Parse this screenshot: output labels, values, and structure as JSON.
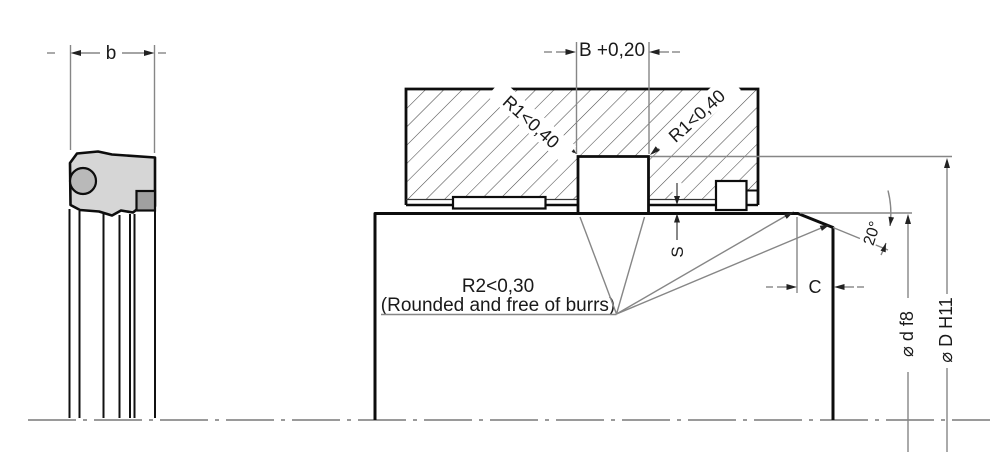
{
  "drawing": {
    "dims": {
      "seal_width": "b",
      "groove_width": "B +0,20",
      "radius1_left": "R1<0,40",
      "radius1_right": "R1<0,40",
      "radius2_line1": "R2<0,30",
      "radius2_line2": "(Rounded and free of burrs)",
      "gap": "S",
      "chamfer_angle": "20°",
      "chamfer_length": "C",
      "rod_diameter": "⌀ d f8",
      "groove_diameter": "⌀ D H11"
    },
    "colors": {
      "background": "#ffffff",
      "outline": "#0d0d0d",
      "dimension_line": "#868686",
      "hatch": "#4a4a4a",
      "seal_body_fill": "#d6d6d6",
      "oring_fill": "#b9b9b9",
      "backup_ring_fill": "#a0a0a0",
      "text": "#1a1a1a"
    }
  }
}
